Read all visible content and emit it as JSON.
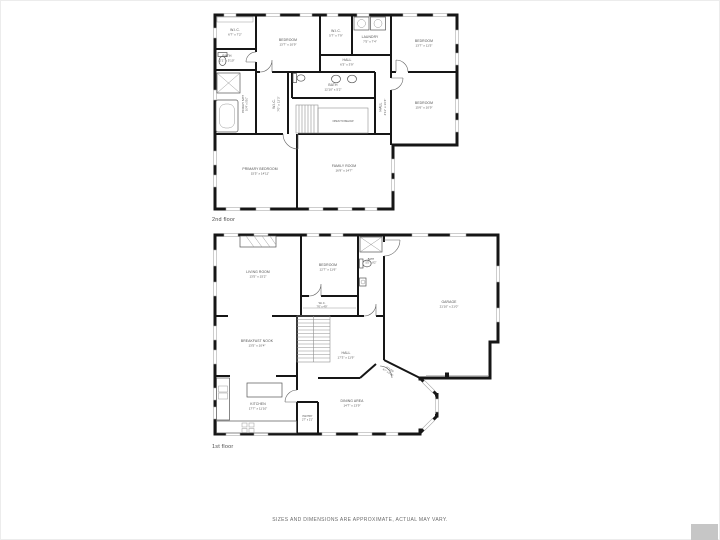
{
  "colors": {
    "wall": "#161616",
    "label": "#4f4f4f",
    "watermark": "#c6c6c6"
  },
  "disclaimer": "SIZES AND DIMENSIONS ARE APPROXIMATE, ACTUAL MAY VARY.",
  "floors": [
    {
      "label": "2nd floor",
      "rooms": {
        "wic1": {
          "name": "W.I.C.",
          "dims": "6'7\" x 7'2\""
        },
        "bath1": {
          "name": "BATH",
          "dims": "2'1\" x 5'10\""
        },
        "bedroom1": {
          "name": "BEDROOM",
          "dims": "13'7\" x 10'9\""
        },
        "wic2": {
          "name": "W.I.C.",
          "dims": "5'7\" x 7'9\""
        },
        "laundry": {
          "name": "LAUNDRY",
          "dims": "7'5\" x 7'4\""
        },
        "bedroom2": {
          "name": "BEDROOM",
          "dims": "13'7\" x 11'5\""
        },
        "hall": {
          "name": "HALL",
          "dims": "6'3\" x 3'9\""
        },
        "bath2": {
          "name": "BATH",
          "dims": "12'10\" x 5'2\""
        },
        "hallvert": {
          "name": "HALL",
          "dims": "4'11\" x 16'4\""
        },
        "primarybath": {
          "name": "PRIMARY BATH",
          "dims": "10'4\" x 5'10\""
        },
        "wic3": {
          "name": "W.I.C.",
          "dims": "7'0\" x 12'3\""
        },
        "bedroom3": {
          "name": "BEDROOM",
          "dims": "15'6\" x 10'9\""
        },
        "open": {
          "name": "OPEN TO BELOW"
        },
        "primarybedroom": {
          "name": "PRIMARY BEDROOM",
          "dims": "15'5\" x 14'11\""
        },
        "familyroom": {
          "name": "FAMILY ROOM",
          "dims": "16'9\" x 14'7\""
        }
      }
    },
    {
      "label": "1st floor",
      "rooms": {
        "livingroom": {
          "name": "LIVING ROOM",
          "dims": "13'5\" x 15'2\""
        },
        "bedroom": {
          "name": "BEDROOM",
          "dims": "12'7\" x 11'6\""
        },
        "wic": {
          "name": "W.I.C.",
          "dims": "7'6\" x 4'9\""
        },
        "bath": {
          "name": "BATH",
          "dims": "5'5\" x 8'2\""
        },
        "garage": {
          "name": "GARAGE",
          "dims": "21'10\" x 21'0\""
        },
        "breakfastnook": {
          "name": "BREAKFAST NOOK",
          "dims": "13'5\" x 10'4\""
        },
        "hall": {
          "name": "HALL",
          "dims": "17'3\" x 11'9\""
        },
        "foyer": {
          "name": "FOYER",
          "dims": "6'7\" x 6'10\""
        },
        "kitchen": {
          "name": "KITCHEN",
          "dims": "17'7\" x 11'10\""
        },
        "pantry": {
          "name": "PANTRY",
          "dims": "2'7\" x 2'1\""
        },
        "diningarea": {
          "name": "DINING AREA",
          "dims": "14'7\" x 13'9\""
        }
      }
    }
  ]
}
